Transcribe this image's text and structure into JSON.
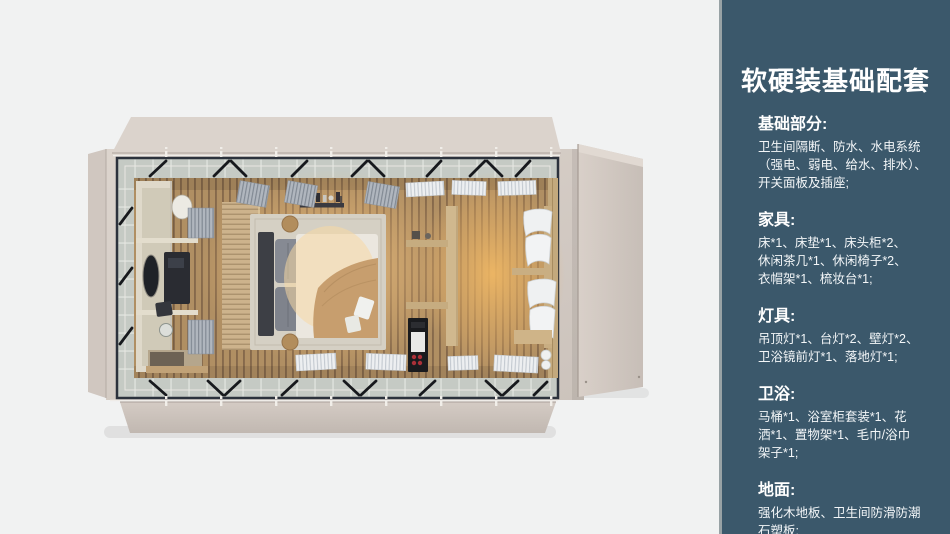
{
  "page": {
    "background_color": "#f1f2f2",
    "description": "Interior design package sheet: top-down 3D render of a modular guest-room cabin (bathroom, wardrobe, double bed, lounge) beside a dark slate info panel"
  },
  "render": {
    "alt": "Top-down 3D render of a rectangular cabin with fold-out beige wall panels, glazed perimeter band with black roof braces, wood-slat floor, bathroom block at left, double bed at center and curtained lounge at right",
    "colors": {
      "shell_beige": "#d6cdc6",
      "glass_band": "#c5cac4",
      "frame_dark": "#2c323c",
      "floor_wood": "#b08f63",
      "warm_glow": "#f0bd79"
    }
  },
  "panel": {
    "background_color": "#3b586b",
    "edge_color": "#98a2a5",
    "text_color": "#ffffff",
    "title": "软硬装基础配套",
    "sections": [
      {
        "heading": "基础部分:",
        "body": "卫生间隔断、防水、水电系统\n（强电、弱电、给水、排水）、\n开关面板及插座;"
      },
      {
        "heading": "家具:",
        "body": "床*1、床垫*1、床头柜*2、\n休闲茶几*1、休闲椅子*2、\n衣帽架*1、梳妆台*1;"
      },
      {
        "heading": "灯具:",
        "body": "吊顶灯*1、台灯*2、壁灯*2、\n卫浴镜前灯*1、落地灯*1;"
      },
      {
        "heading": "卫浴:",
        "body": "马桶*1、浴室柜套装*1、花\n洒*1、置物架*1、毛巾/浴巾\n架子*1;"
      },
      {
        "heading": "地面:",
        "body": "强化木地板、卫生间防滑防潮\n石塑板;"
      }
    ]
  }
}
